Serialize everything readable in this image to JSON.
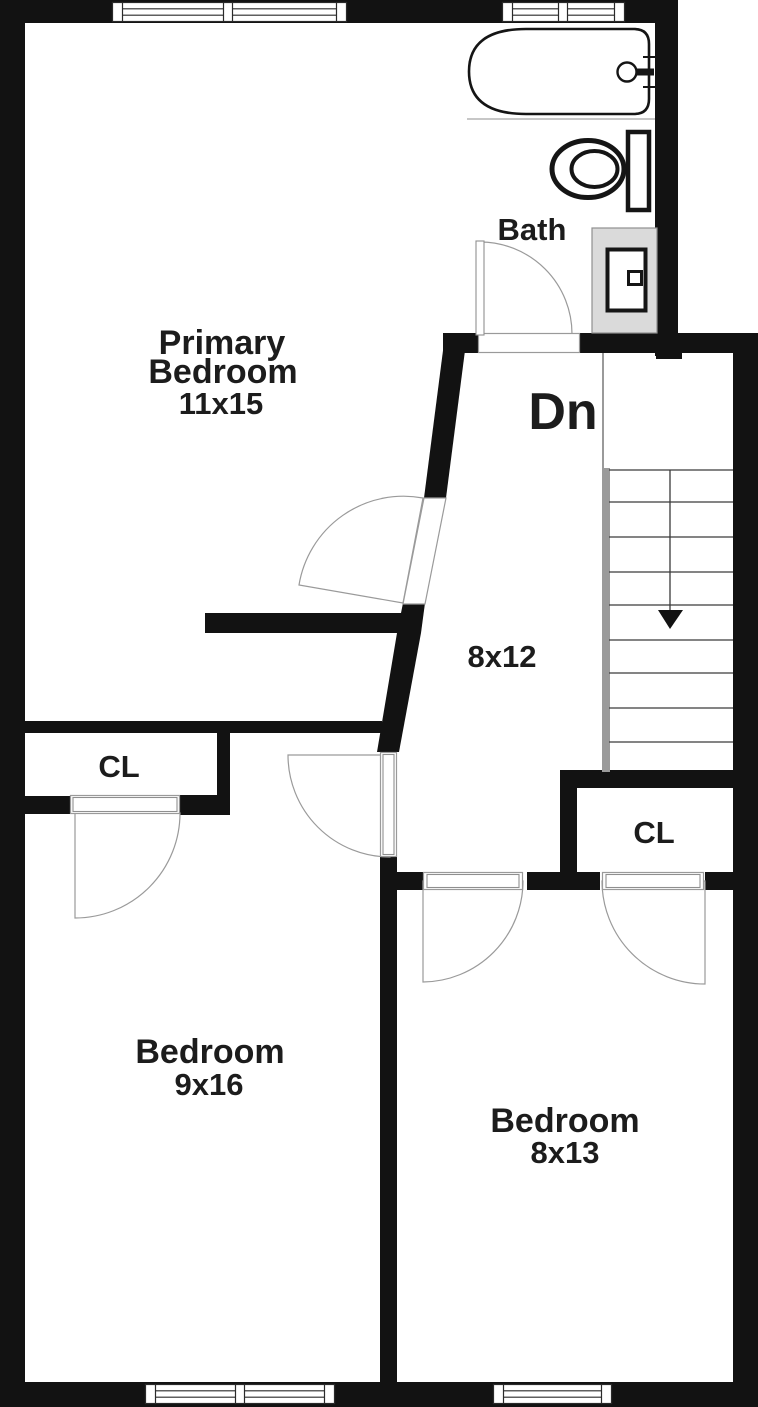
{
  "floor_plan": {
    "type": "residential-floor-plan",
    "rooms": [
      {
        "name_line1": "Primary",
        "name_line2": "Bedroom",
        "dimensions": "11x15"
      },
      {
        "name": "Bath"
      },
      {
        "dimensions": "8x12"
      },
      {
        "name": "CL"
      },
      {
        "name": "CL"
      },
      {
        "name": "Bedroom",
        "dimensions": "9x16"
      },
      {
        "name": "Bedroom",
        "dimensions": "8x13"
      }
    ],
    "stairs": {
      "direction_label": "Dn",
      "treads": 9
    },
    "fixtures": [
      "bathtub",
      "faucet",
      "toilet",
      "vanity-sink"
    ],
    "windows": 4,
    "doors": 6,
    "colors": {
      "wall": "#121212",
      "background": "#ffffff",
      "thin_line": "#8f8f8f",
      "stair_stringer": "#9a9a9a",
      "vanity_fill": "#dadada",
      "text": "#1c1c1c"
    }
  }
}
